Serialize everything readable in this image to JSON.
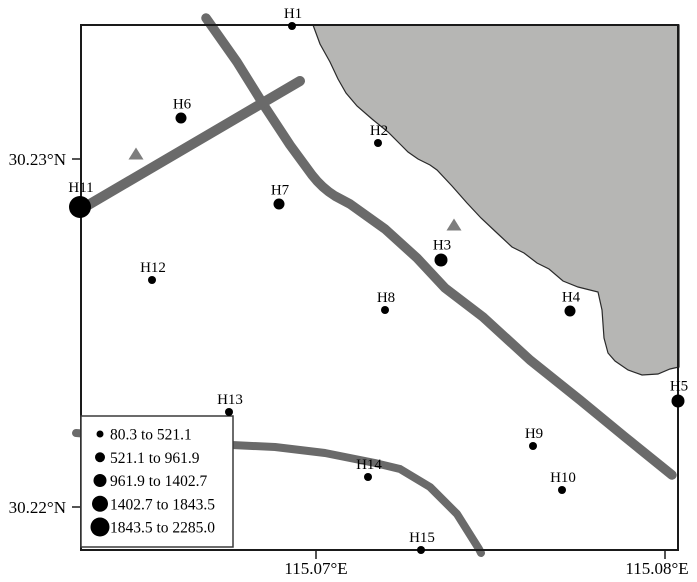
{
  "figure": {
    "colors": {
      "water_region": "#b6b6b4",
      "road": "#6a6a6a",
      "triangle": "#7d7d7d",
      "marker": "#000000",
      "frame": "#1a1a1a",
      "legend_border": "#3a3a3a",
      "legend_fill": "#ffffff"
    },
    "axes": {
      "y_ticks": [
        {
          "label": "30.23°N",
          "y": 159
        },
        {
          "label": "30.22°N",
          "y": 507
        }
      ],
      "x_ticks": [
        {
          "label": "115.07°E",
          "tick_x": 316,
          "label_x": 316
        },
        {
          "label": "115.08°E",
          "tick_x": 665,
          "label_x": 657
        }
      ]
    },
    "size_class_radius": {
      "1": 4,
      "2": 5.5,
      "3": 6.5,
      "4": 8,
      "5": 11
    },
    "stations": [
      {
        "id": "H1",
        "x": 292,
        "y": 26,
        "size_class": 1
      },
      {
        "id": "H2",
        "x": 378,
        "y": 143,
        "size_class": 1
      },
      {
        "id": "H3",
        "x": 441,
        "y": 260,
        "size_class": 3
      },
      {
        "id": "H4",
        "x": 570,
        "y": 311,
        "size_class": 2
      },
      {
        "id": "H5",
        "x": 678,
        "y": 401,
        "size_class": 3
      },
      {
        "id": "H6",
        "x": 181,
        "y": 118,
        "size_class": 2
      },
      {
        "id": "H7",
        "x": 279,
        "y": 204,
        "size_class": 2
      },
      {
        "id": "H8",
        "x": 385,
        "y": 310,
        "size_class": 1
      },
      {
        "id": "H9",
        "x": 533,
        "y": 446,
        "size_class": 1
      },
      {
        "id": "H10",
        "x": 562,
        "y": 490,
        "size_class": 1
      },
      {
        "id": "H11",
        "x": 80,
        "y": 207,
        "size_class": 5
      },
      {
        "id": "H12",
        "x": 152,
        "y": 280,
        "size_class": 1
      },
      {
        "id": "H13",
        "x": 229,
        "y": 412,
        "size_class": 1
      },
      {
        "id": "H14",
        "x": 368,
        "y": 477,
        "size_class": 1
      },
      {
        "id": "H15",
        "x": 421,
        "y": 550,
        "size_class": 1
      }
    ],
    "triangles": [
      {
        "x": 136,
        "y": 154
      },
      {
        "x": 454,
        "y": 225
      }
    ],
    "legend": {
      "box": {
        "x": 81,
        "y": 416,
        "width": 152,
        "height": 131
      },
      "items": [
        {
          "label": "80.3 to 521.1",
          "diameter": 7
        },
        {
          "label": "521.1 to 961.9",
          "diameter": 10
        },
        {
          "label": "961.9 to 1402.7",
          "diameter": 13
        },
        {
          "label": "1402.7 to 1843.5",
          "diameter": 16
        },
        {
          "label": "1843.5 to 2285.0",
          "diameter": 19
        }
      ]
    }
  },
  "chart_data": {
    "type": "scatter",
    "title": "",
    "xlabel": "Longitude",
    "ylabel": "Latitude",
    "x_tick_labels": [
      "115.07°E",
      "115.08°E"
    ],
    "y_tick_labels": [
      "30.23°N",
      "30.22°N"
    ],
    "legend_title_ranges": [
      "80.3 to 521.1",
      "521.1 to 961.9",
      "961.9 to 1402.7",
      "1402.7 to 1843.5",
      "1843.5 to 2285.0"
    ],
    "series": [
      {
        "name": "H1",
        "lon": 115.0693,
        "lat": 30.2338,
        "value_range": "80.3 to 521.1"
      },
      {
        "name": "H2",
        "lon": 115.0718,
        "lat": 30.2305,
        "value_range": "80.3 to 521.1"
      },
      {
        "name": "H3",
        "lon": 115.0736,
        "lat": 30.2271,
        "value_range": "961.9 to 1402.7"
      },
      {
        "name": "H4",
        "lon": 115.0773,
        "lat": 30.2256,
        "value_range": "521.1 to 961.9"
      },
      {
        "name": "H5",
        "lon": 115.0804,
        "lat": 30.223,
        "value_range": "961.9 to 1402.7"
      },
      {
        "name": "H6",
        "lon": 115.0661,
        "lat": 30.2312,
        "value_range": "521.1 to 961.9"
      },
      {
        "name": "H7",
        "lon": 115.0689,
        "lat": 30.2287,
        "value_range": "521.1 to 961.9"
      },
      {
        "name": "H8",
        "lon": 115.072,
        "lat": 30.2257,
        "value_range": "80.3 to 521.1"
      },
      {
        "name": "H9",
        "lon": 115.0762,
        "lat": 30.2218,
        "value_range": "80.3 to 521.1"
      },
      {
        "name": "H10",
        "lon": 115.077,
        "lat": 30.2205,
        "value_range": "80.3 to 521.1"
      },
      {
        "name": "H11",
        "lon": 115.0632,
        "lat": 30.2286,
        "value_range": "1843.5 to 2285.0"
      },
      {
        "name": "H12",
        "lon": 115.0652,
        "lat": 30.2265,
        "value_range": "80.3 to 521.1"
      },
      {
        "name": "H13",
        "lon": 115.0675,
        "lat": 30.2227,
        "value_range": "80.3 to 521.1"
      },
      {
        "name": "H14",
        "lon": 115.0715,
        "lat": 30.2209,
        "value_range": "80.3 to 521.1"
      },
      {
        "name": "H15",
        "lon": 115.073,
        "lat": 30.2188,
        "value_range": "80.3 to 521.1"
      }
    ]
  }
}
